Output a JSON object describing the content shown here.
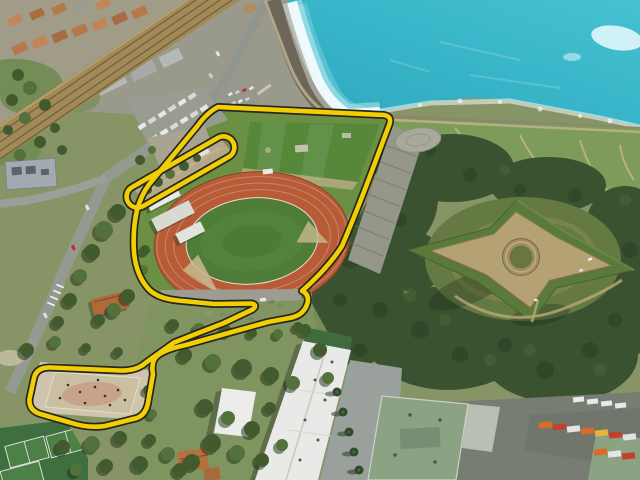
{
  "meta": {
    "type": "oblique-aerial-photograph",
    "description": "Aerial view of a seaside municipal sports complex outlined by a thick yellow perimeter highlight: athletics track with grass infield, upper pitch, camper parking, a sand boules court and tennis courts, beside a railway line, a turquoise sea with surf, and a four-pointed star fort on a wooded headland"
  },
  "annotation": {
    "label": "site-perimeter-highlight",
    "color": "#f2cf05",
    "casing_color": "#26261c",
    "main_route_path": "M 218,107 L 384,115 Q 392,116.5 389.5,124 L 373,168 Q 357,211 342,246 Q 328,268 302,291 Q 309.5,294 307.5,303 Q 304,315.5 289.5,318 L 268,322 L 232,332 L 186,345 Q 157,351 153.5,361 Q 151.5,368 153,374 L 148.5,400 Q 146.5,417 133,419 L 105,426 Q 88,428.5 70,422.5 L 42,414.5 Q 28.5,411 29.5,399 L 34,378 Q 36.5,367 51,367.5 L 120,370.5 Q 137,371 146,362.5 L 174,342.5 L 224,323 L 252.5,309.5 Q 258,305.5 252,303.5 L 214,304 L 178,300.5 Q 158,298.5 149,289.5 Q 136,275.5 134,252 Q 132.5,230 137,210 Q 141,195.5 149,184.5 L 197,126.5 Q 207,112.5 218,107 Z",
    "nw_strip_loop_path": "M 131.5,187.5 L 218.5,137.5 A 11,11 0 0 1 229.5,156.5 L 142.5,206.5 A 11,11 0 0 1 131.5,187.5 Z"
  },
  "colors": {
    "land": "#879465",
    "sea": "#3ab6c9",
    "surf": "#f4feff",
    "beach": "#6e6758",
    "railway": "#a28a58",
    "urban_base": "#a09c88",
    "roof_orange": "#b5784a",
    "lawn": "#7e9c59",
    "forest": "#3a5230",
    "fort_rampart": "#b5a274",
    "fort_glacis": "#5a7a3c",
    "track": "#b85c38",
    "infield": "#4f7c36",
    "pitch": "#57883a",
    "court": "#cfc5ac",
    "tennis": "#3f6f3f",
    "white_roof": "#e9e9e7",
    "green_roof": "#8ba283",
    "road": "#949a91"
  },
  "features": [
    {
      "id": "sea",
      "label": "turquoise sea with surf"
    },
    {
      "id": "pebble-beach",
      "label": "dark pebble beach"
    },
    {
      "id": "railway-corridor",
      "label": "coastal railway line"
    },
    {
      "id": "town",
      "label": "town roofs and warehouses"
    },
    {
      "id": "athletics-track",
      "label": "red athletics track with grass infield"
    },
    {
      "id": "football-pitch",
      "label": "upper grass pitch"
    },
    {
      "id": "camper-parking",
      "label": "rows of parked campers"
    },
    {
      "id": "grandstand-terraces",
      "label": "terraced steps east of stadium"
    },
    {
      "id": "star-fort",
      "label": "four-pointed star fort with circular courtyard"
    },
    {
      "id": "woodland",
      "label": "dense woodland around the fort"
    },
    {
      "id": "headland-lawns",
      "label": "headland lawns with paths"
    },
    {
      "id": "boules-court",
      "label": "sand court inside the yellow loop"
    },
    {
      "id": "tennis-courts",
      "label": "green tennis courts"
    },
    {
      "id": "white-school-building",
      "label": "long white-roofed building"
    },
    {
      "id": "green-roof-buildings",
      "label": "green-roofed depot with trucks"
    },
    {
      "id": "yellow-route",
      "label": "yellow site perimeter highlight"
    }
  ]
}
